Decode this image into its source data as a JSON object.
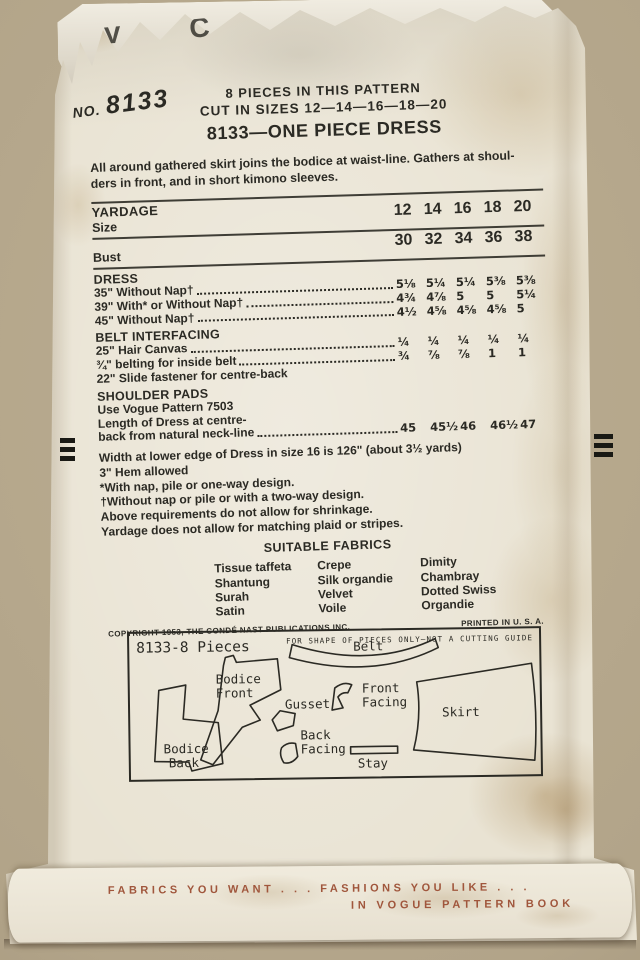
{
  "colors": {
    "ink": "#2b2a24",
    "accent_red": "#a0563c",
    "paper": "#e9e3d3",
    "backdrop": "#b2a489"
  },
  "envelope": {
    "torn_logo_fragment": "V C",
    "stamp_prefix": "NO.",
    "stamp_number": "8133"
  },
  "header": {
    "pieces_line": "8 PIECES IN THIS PATTERN",
    "cut_sizes_line": "CUT IN SIZES 12—14—16—18—20",
    "title": "8133—ONE PIECE DRESS",
    "description_lines": [
      "All around gathered skirt joins the bodice at waist-line. Gathers at shoul-",
      "ders in front, and in short kimono sleeves."
    ]
  },
  "yardage_table": {
    "yardage_label": "YARDAGE",
    "size_label": "Size",
    "sizes": [
      "12",
      "14",
      "16",
      "18",
      "20"
    ],
    "bust_label": "Bust",
    "bust_values": [
      "30",
      "32",
      "34",
      "36",
      "38"
    ],
    "sections": [
      {
        "header": "DRESS",
        "rows": [
          {
            "label": "35\" Without Nap†",
            "values": [
              "5⅛",
              "5¼",
              "5¼",
              "5⅜",
              "5⅜"
            ]
          },
          {
            "label": "39\" With* or Without Nap†",
            "values": [
              "4¾",
              "4⅞",
              "5",
              "5",
              "5¼"
            ]
          },
          {
            "label": "45\" Without Nap†",
            "values": [
              "4½",
              "4⅝",
              "4⅝",
              "4⅝",
              "5"
            ]
          }
        ]
      },
      {
        "header": "BELT INTERFACING",
        "rows": [
          {
            "label": "25\" Hair Canvas",
            "values": [
              "¼",
              "¼",
              "¼",
              "¼",
              "¼"
            ]
          },
          {
            "label": "¾\" belting for inside belt",
            "values": [
              "¾",
              "⅞",
              "⅞",
              "1",
              "1"
            ]
          }
        ]
      }
    ],
    "slide_fastener_line": "22\" Slide fastener for centre-back",
    "shoulder_pads_header": "SHOULDER PADS",
    "shoulder_pads_line": "Use Vogue Pattern 7503",
    "length_row": {
      "label_line1": "Length of Dress at centre-",
      "label_line2": "back from natural neck-line",
      "values": [
        "45",
        "45½",
        "46",
        "46½",
        "47"
      ]
    }
  },
  "notes": [
    "Width at lower edge of Dress in size 16 is 126\" (about 3½ yards)",
    "3\" Hem allowed",
    "*With nap, pile or one-way design.",
    "†Without nap or pile or with a two-way design.",
    "Above requirements do not allow for shrinkage.",
    "Yardage does not allow for matching plaid or stripes."
  ],
  "fabrics": {
    "header": "SUITABLE FABRICS",
    "columns": [
      [
        "Tissue taffeta",
        "Shantung",
        "Surah",
        "Satin"
      ],
      [
        "Crepe",
        "Silk organdie",
        "Velvet",
        "Voile"
      ],
      [
        "Dimity",
        "Chambray",
        "Dotted Swiss",
        "Organdie"
      ]
    ]
  },
  "imprint": {
    "copyright": "COPYRIGHT 1953, THE CONDÉ NAST PUBLICATIONS INC.",
    "printed": "PRINTED IN U. S. A."
  },
  "diagram": {
    "title": "8133-8 Pieces",
    "note": "FOR SHAPE OF PIECES ONLY—NOT A CUTTING GUIDE",
    "labels": {
      "belt": "Belt",
      "bodice_front_1": "Bodice",
      "bodice_front_2": "Front",
      "bodice_back_1": "Bodice",
      "bodice_back_2": "Back",
      "gusset": "Gusset",
      "front_facing_1": "Front",
      "front_facing_2": "Facing",
      "back_facing_1": "Back",
      "back_facing_2": "Facing",
      "stay": "Stay",
      "skirt": "Skirt"
    }
  },
  "banner": {
    "line1": "FABRICS YOU WANT . . . FASHIONS YOU LIKE . . .",
    "line2": "IN VOGUE PATTERN BOOK"
  }
}
